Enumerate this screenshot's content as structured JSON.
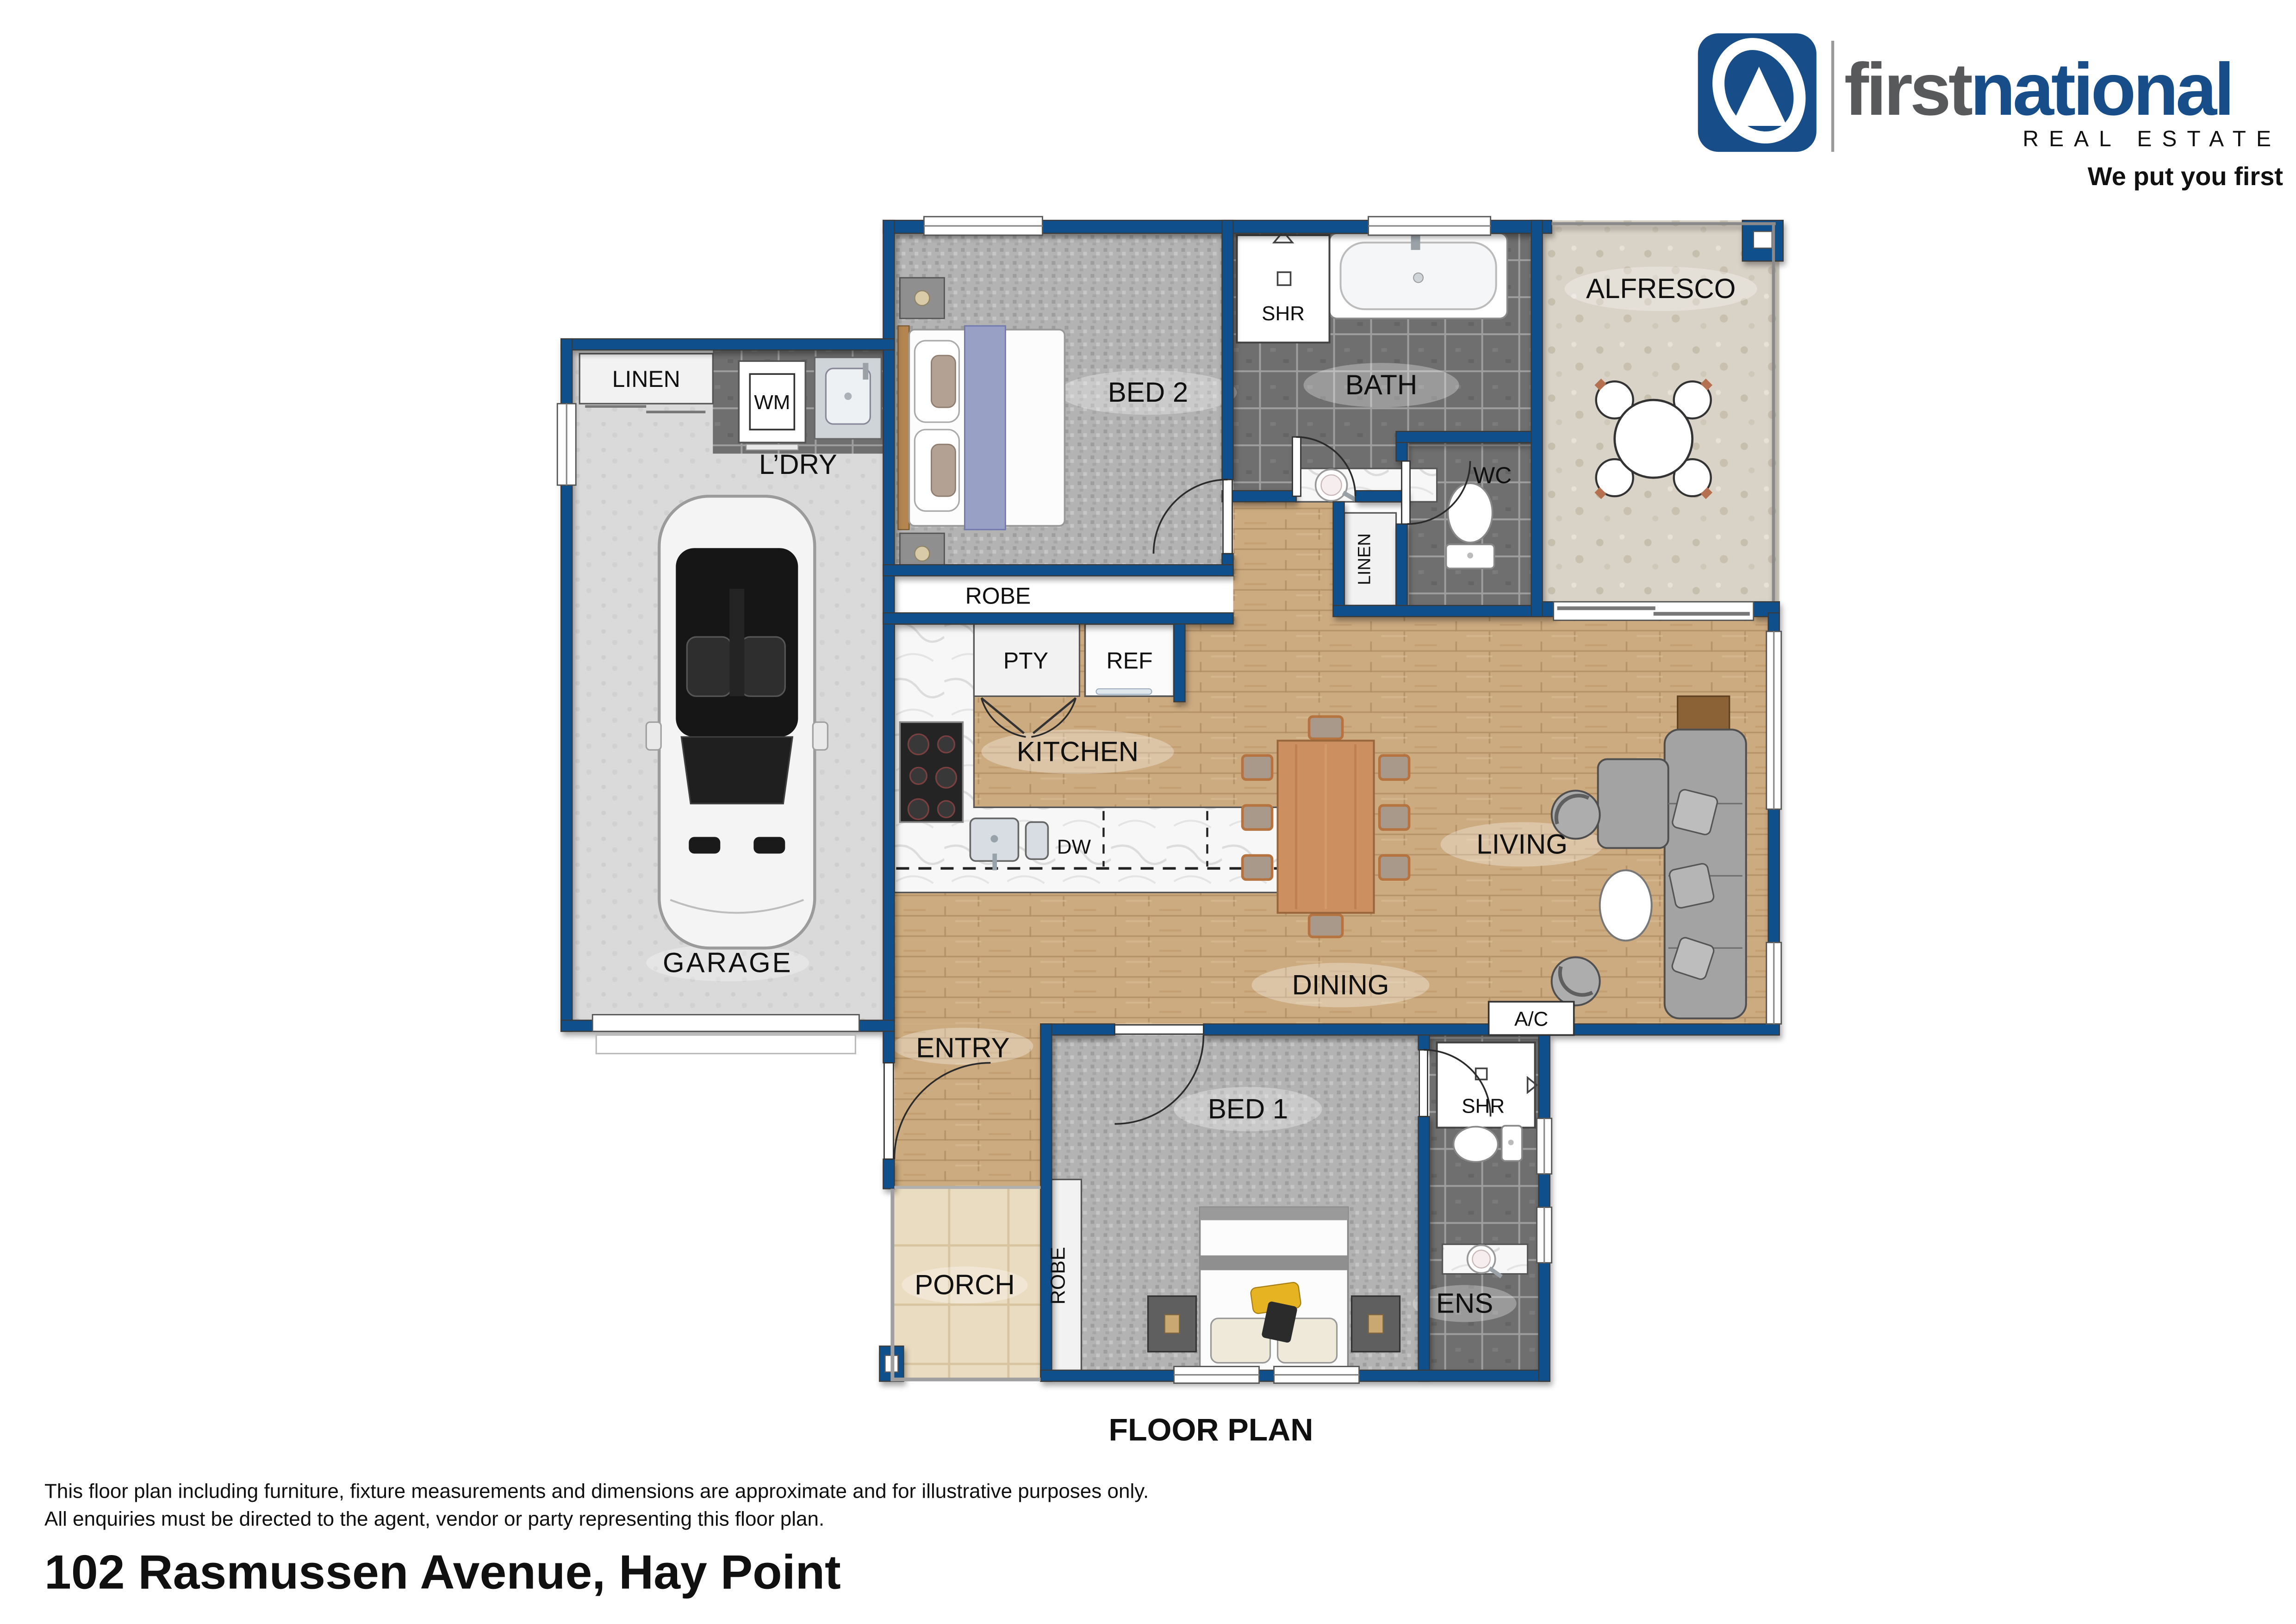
{
  "brand": {
    "word1": "first",
    "word2": "national",
    "subtext": "REAL ESTATE",
    "tagline": "We put you first",
    "brand_blue": "#174e8a",
    "brand_gray": "#58595b"
  },
  "plan": {
    "labels": {
      "linen_garage": "LINEN",
      "wm": "WM",
      "ldry": "L’DRY",
      "garage": "GARAGE",
      "bed2": "BED 2",
      "robe_bed2": "ROBE",
      "shr_bath": "SHR",
      "bath": "BATH",
      "wc": "WC",
      "linen_hall": "LINEN",
      "alfresco": "ALFRESCO",
      "pty": "PTY",
      "ref": "REF",
      "kitchen": "KITCHEN",
      "dw": "DW",
      "living": "LIVING",
      "dining": "DINING",
      "ac": "A/C",
      "entry": "ENTRY",
      "bed1": "BED 1",
      "robe_bed1": "ROBE",
      "shr_ens": "SHR",
      "ens": "ENS",
      "porch": "PORCH"
    },
    "colors": {
      "wall_blue": "#0f4f8b",
      "wood_floor": "#cdab80",
      "carpet": "#b3b3b3",
      "dark_tile": "#6f6f6f",
      "alfresco_floor": "#d9d3c7",
      "porch_tile": "#eadcc0"
    }
  },
  "title": "FLOOR PLAN",
  "disclaimer": [
    "This floor plan including furniture, fixture measurements and dimensions are approximate and for illustrative purposes only.",
    "All enquiries must be directed to the agent, vendor or party representing this floor plan."
  ],
  "address": "102 Rasmussen Avenue, Hay Point"
}
